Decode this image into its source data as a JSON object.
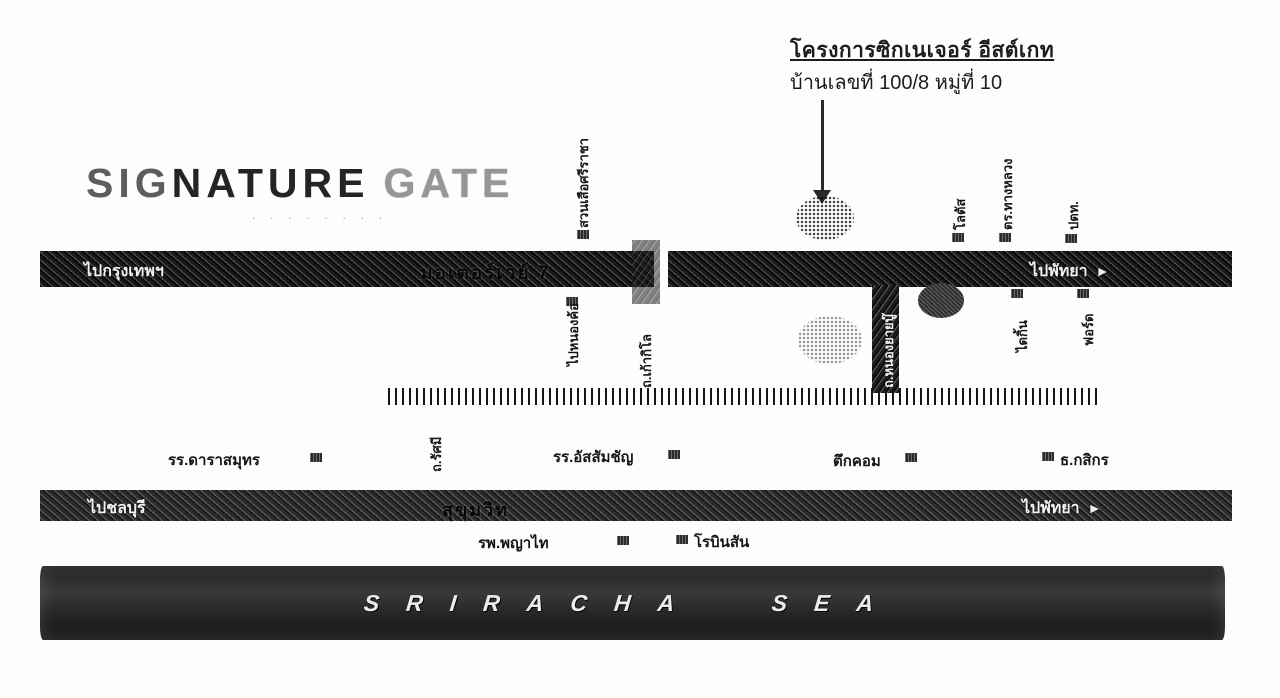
{
  "header": {
    "project_title": "โครงการซิกเนเจอร์ อีสต์เกท",
    "address_line": "บ้านเลขที่ 100/8 หมู่ที่ 10"
  },
  "logo": {
    "part1": "SIG",
    "part2": "NATURE",
    "part3": "GATE",
    "tagline": "· · · · · · · ·"
  },
  "roads": {
    "motorway": {
      "name": "มอเตอร์เวย์ 7",
      "left_label": "ไปกรุงเทพฯ",
      "right_label": "ไปพัทยา",
      "right_arrow": "►"
    },
    "sukhumvit": {
      "name": "สุขุมวิท",
      "left_label": "ไปชลบุรี",
      "right_label": "ไปพัทยา",
      "right_arrow": "►"
    },
    "kao_kilo": {
      "name": "ถ.เก้ากิโล"
    },
    "nong_yai_bu": {
      "name": "ถ.หนองยายบู๊"
    },
    "rasami": {
      "name": "ถ.รัศมี"
    }
  },
  "landmarks": {
    "tiger_zoo": "สวนเสือศรีราชา",
    "lotus": "โลตัส",
    "highway_police": "ตร.ทางหลวง",
    "ptt": "ปตท.",
    "nong_kho": "ไปหนองค้อ",
    "daikin": "ไดกิ้น",
    "ford": "ฟอร์ด",
    "darasamutr_school": "รร.ดาราสมุทร",
    "assumption_school": "รร.อัสสัมชัญ",
    "tukcom": "ตึกคอม",
    "kasikorn_bank": "ธ.กสิกร",
    "phyathai_hospital": "รพ.พญาไท",
    "robinson": "โรบินสัน"
  },
  "sea": {
    "label": "SRIRACHA SEA"
  },
  "colors": {
    "ink": "#1c1c1c",
    "road": "#3b3b3b",
    "sea": "#222222",
    "paper": "#fdfdfc"
  }
}
